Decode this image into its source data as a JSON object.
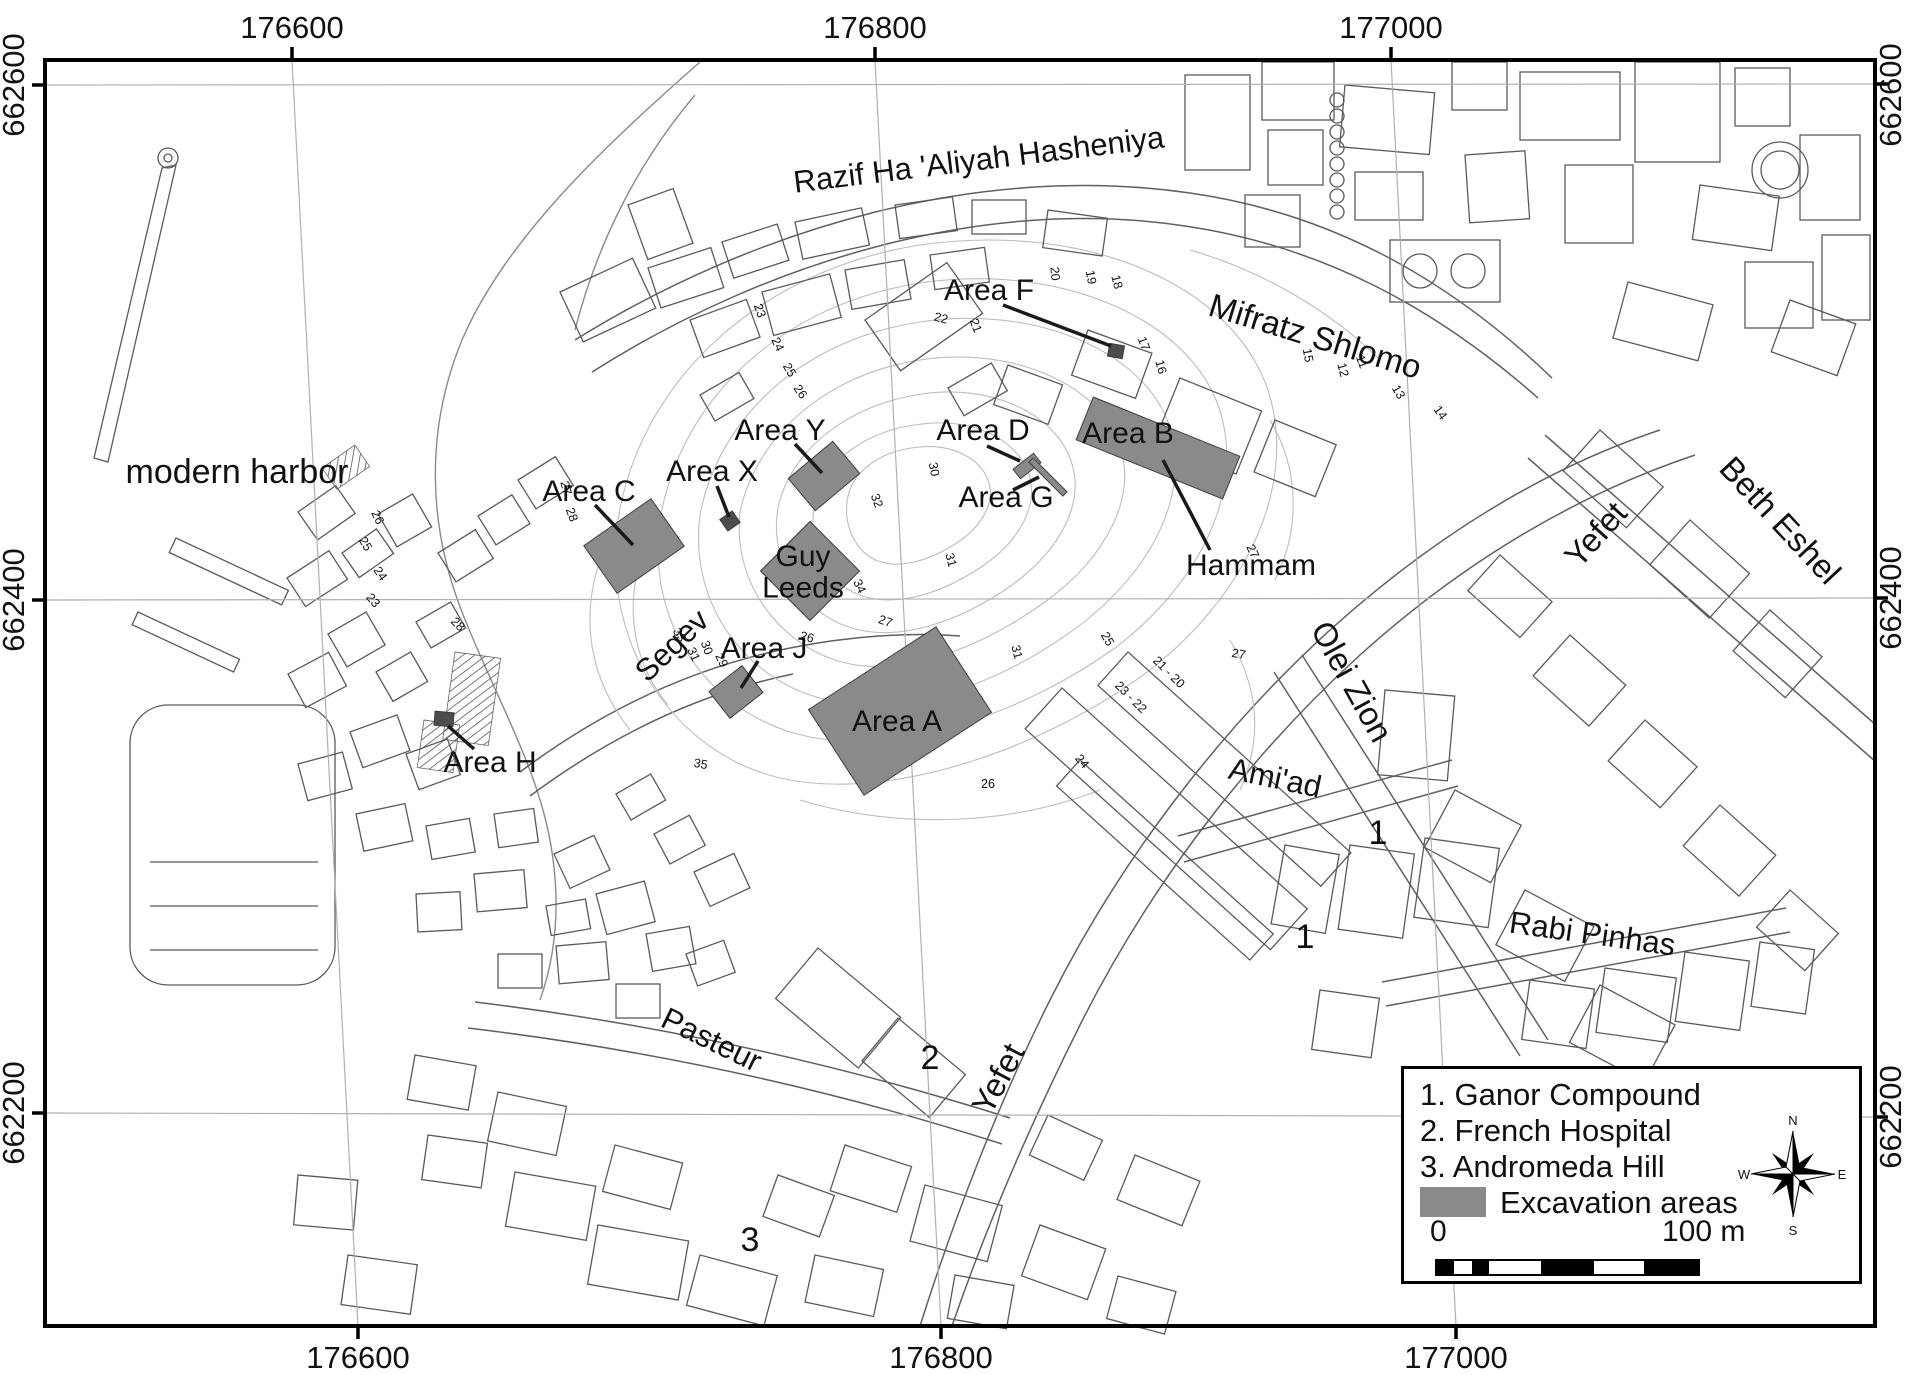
{
  "colors": {
    "excavation_fill": "#8a8a8a",
    "excavation_dark": "#4c4c4c",
    "leader": "#1a1a1a",
    "grid": "#b0b0b0",
    "border": "#000000",
    "text": "#111111",
    "contour_text": "#555555"
  },
  "frame": {
    "x": 45,
    "y": 60,
    "w": 1830,
    "h": 1266
  },
  "axes": {
    "top": [
      {
        "text": "176600",
        "x": 292
      },
      {
        "text": "176800",
        "x": 875
      },
      {
        "text": "177000",
        "x": 1391
      }
    ],
    "bottom": [
      {
        "text": "176600",
        "x": 358
      },
      {
        "text": "176800",
        "x": 941
      },
      {
        "text": "177000",
        "x": 1456
      }
    ],
    "left": [
      {
        "text": "662600",
        "y": 85
      },
      {
        "text": "662400",
        "y": 600
      },
      {
        "text": "662200",
        "y": 1113
      }
    ],
    "right": [
      {
        "text": "662600",
        "y": 95
      },
      {
        "text": "662400",
        "y": 598
      },
      {
        "text": "662200",
        "y": 1117
      }
    ]
  },
  "grid": {
    "vertical": [
      {
        "x_top": 292,
        "x_bottom": 358
      },
      {
        "x_top": 875,
        "x_bottom": 941
      },
      {
        "x_top": 1391,
        "x_bottom": 1456
      }
    ],
    "horizontal": [
      {
        "y_left": 85,
        "y_right": 84
      },
      {
        "y_left": 600,
        "y_right": 598
      },
      {
        "y_left": 1113,
        "y_right": 1117
      }
    ]
  },
  "map_labels": [
    {
      "name": "street-razif",
      "text": "Razif Ha 'Aliyah Hasheniya",
      "x": 980,
      "y": 170,
      "rot": -7,
      "size": 31
    },
    {
      "name": "street-mifratz-shlomo",
      "text": "Mifratz Shlomo",
      "x": 1312,
      "y": 347,
      "rot": 17,
      "size": 33
    },
    {
      "name": "street-yefet-north",
      "text": "Yefet",
      "x": 1604,
      "y": 542,
      "rot": -48,
      "size": 33
    },
    {
      "name": "street-beth-eshel",
      "text": "Beth Eshel",
      "x": 1772,
      "y": 528,
      "rot": 47,
      "size": 33
    },
    {
      "name": "street-olei-zion",
      "text": "Olei Zion",
      "x": 1342,
      "y": 687,
      "rot": 61,
      "size": 33
    },
    {
      "name": "street-amiad",
      "text": "Ami'ad",
      "x": 1273,
      "y": 788,
      "rot": 12,
      "size": 31
    },
    {
      "name": "street-rabi-pinhas",
      "text": "Rabi Pinhas",
      "x": 1591,
      "y": 944,
      "rot": 8,
      "size": 31
    },
    {
      "name": "street-pasteur",
      "text": "Pasteur",
      "x": 707,
      "y": 1049,
      "rot": 26,
      "size": 31
    },
    {
      "name": "street-segev",
      "text": "Segev",
      "x": 679,
      "y": 653,
      "rot": -44,
      "size": 31
    },
    {
      "name": "street-yefet-south",
      "text": "Yefet",
      "x": 1008,
      "y": 1084,
      "rot": -62,
      "size": 33
    },
    {
      "name": "place-modern-harbor",
      "text": "modern harbor",
      "x": 237,
      "y": 483,
      "rot": 0,
      "size": 34
    },
    {
      "name": "place-hammam",
      "text": "Hammam",
      "x": 1251,
      "y": 575,
      "rot": 0,
      "size": 30
    },
    {
      "name": "area-label-c",
      "text": "Area C",
      "x": 589,
      "y": 501,
      "rot": 0,
      "size": 30
    },
    {
      "name": "area-label-x",
      "text": "Area X",
      "x": 712,
      "y": 481,
      "rot": 0,
      "size": 30
    },
    {
      "name": "area-label-y",
      "text": "Area Y",
      "x": 780,
      "y": 440,
      "rot": 0,
      "size": 30
    },
    {
      "name": "area-label-d",
      "text": "Area D",
      "x": 983,
      "y": 440,
      "rot": 0,
      "size": 30
    },
    {
      "name": "area-label-g",
      "text": "Area G",
      "x": 1006,
      "y": 507,
      "rot": 0,
      "size": 30
    },
    {
      "name": "area-label-f",
      "text": "Area F",
      "x": 989,
      "y": 300,
      "rot": 0,
      "size": 30
    },
    {
      "name": "area-label-b",
      "text": "Area B",
      "x": 1128,
      "y": 443,
      "rot": 0,
      "size": 30
    },
    {
      "name": "area-label-j",
      "text": "Area J",
      "x": 764,
      "y": 658,
      "rot": 0,
      "size": 30
    },
    {
      "name": "area-label-a",
      "text": "Area A",
      "x": 897,
      "y": 731,
      "rot": 0,
      "size": 30
    },
    {
      "name": "area-label-h",
      "text": "Area H",
      "x": 490,
      "y": 772,
      "rot": 0,
      "size": 30
    },
    {
      "name": "area-label-guy-leeds",
      "lines": [
        "Guy",
        "Leeds"
      ],
      "x": 803,
      "y": 566,
      "rot": 0,
      "size": 30
    }
  ],
  "site_numbers": [
    {
      "text": "1",
      "x": 1378,
      "y": 844
    },
    {
      "text": "1",
      "x": 1305,
      "y": 948
    },
    {
      "text": "2",
      "x": 930,
      "y": 1069
    },
    {
      "text": "3",
      "x": 750,
      "y": 1251
    }
  ],
  "contour_labels": [
    {
      "text": "23",
      "x": 756,
      "y": 312,
      "rot": 70
    },
    {
      "text": "24",
      "x": 774,
      "y": 346,
      "rot": 65
    },
    {
      "text": "25",
      "x": 786,
      "y": 372,
      "rot": 60
    },
    {
      "text": "26",
      "x": 797,
      "y": 394,
      "rot": 55
    },
    {
      "text": "22",
      "x": 940,
      "y": 322,
      "rot": 15
    },
    {
      "text": "21",
      "x": 972,
      "y": 327,
      "rot": 70
    },
    {
      "text": "20",
      "x": 1051,
      "y": 274,
      "rot": 85
    },
    {
      "text": "19",
      "x": 1087,
      "y": 278,
      "rot": 80
    },
    {
      "text": "18",
      "x": 1113,
      "y": 283,
      "rot": 75
    },
    {
      "text": "15",
      "x": 1304,
      "y": 356,
      "rot": 80
    },
    {
      "text": "12",
      "x": 1339,
      "y": 371,
      "rot": 75
    },
    {
      "text": "11",
      "x": 1358,
      "y": 363,
      "rot": 70
    },
    {
      "text": "13",
      "x": 1395,
      "y": 394,
      "rot": 60
    },
    {
      "text": "14",
      "x": 1437,
      "y": 415,
      "rot": 55
    },
    {
      "text": "27",
      "x": 562,
      "y": 489,
      "rot": 75
    },
    {
      "text": "28",
      "x": 568,
      "y": 516,
      "rot": 70
    },
    {
      "text": "26",
      "x": 374,
      "y": 519,
      "rot": 65
    },
    {
      "text": "25",
      "x": 362,
      "y": 546,
      "rot": 60
    },
    {
      "text": "24",
      "x": 377,
      "y": 576,
      "rot": 55
    },
    {
      "text": "23",
      "x": 370,
      "y": 603,
      "rot": 50
    },
    {
      "text": "28",
      "x": 455,
      "y": 627,
      "rot": 45
    },
    {
      "text": "27",
      "x": 1249,
      "y": 553,
      "rot": 65
    },
    {
      "text": "27",
      "x": 1238,
      "y": 658,
      "rot": 10
    },
    {
      "text": "25",
      "x": 1104,
      "y": 641,
      "rot": 60
    },
    {
      "text": "23 - 22",
      "x": 1128,
      "y": 700,
      "rot": 45
    },
    {
      "text": "21 - 20",
      "x": 1166,
      "y": 675,
      "rot": 45
    },
    {
      "text": "24",
      "x": 1079,
      "y": 764,
      "rot": 50
    },
    {
      "text": "26",
      "x": 988,
      "y": 788,
      "rot": 0
    },
    {
      "text": "31",
      "x": 1013,
      "y": 653,
      "rot": 75
    },
    {
      "text": "30",
      "x": 930,
      "y": 470,
      "rot": 80
    },
    {
      "text": "32",
      "x": 873,
      "y": 502,
      "rot": 70
    },
    {
      "text": "31",
      "x": 947,
      "y": 561,
      "rot": 75
    },
    {
      "text": "34",
      "x": 856,
      "y": 588,
      "rot": 65
    },
    {
      "text": "35",
      "x": 700,
      "y": 768,
      "rot": 10
    },
    {
      "text": "33",
      "x": 676,
      "y": 637,
      "rot": 60
    },
    {
      "text": "31",
      "x": 690,
      "y": 656,
      "rot": 65
    },
    {
      "text": "30",
      "x": 703,
      "y": 649,
      "rot": 70
    },
    {
      "text": "29",
      "x": 718,
      "y": 662,
      "rot": 65
    },
    {
      "text": "26",
      "x": 806,
      "y": 641,
      "rot": 15
    },
    {
      "text": "27",
      "x": 884,
      "y": 625,
      "rot": 20
    },
    {
      "text": "16",
      "x": 1157,
      "y": 368,
      "rot": 75
    },
    {
      "text": "17",
      "x": 1140,
      "y": 345,
      "rot": 70
    }
  ],
  "excavation_areas": [
    {
      "name": "area-c",
      "cx": 634,
      "cy": 546,
      "w": 82,
      "h": 58,
      "rot": -35,
      "shade": "medium"
    },
    {
      "name": "area-x",
      "cx": 730,
      "cy": 521,
      "w": 15,
      "h": 14,
      "rot": -35,
      "shade": "dark"
    },
    {
      "name": "area-y",
      "cx": 824,
      "cy": 476,
      "w": 58,
      "h": 42,
      "rot": -40,
      "shade": "medium"
    },
    {
      "name": "guy-leeds",
      "cx": 810,
      "cy": 571,
      "w": 70,
      "h": 70,
      "rot": -45,
      "shade": "medium"
    },
    {
      "name": "area-j",
      "cx": 736,
      "cy": 692,
      "w": 42,
      "h": 34,
      "rot": -38,
      "shade": "medium"
    },
    {
      "name": "area-a",
      "cx": 900,
      "cy": 711,
      "w": 152,
      "h": 102,
      "rot": -33,
      "shade": "medium"
    },
    {
      "name": "area-b",
      "cx": 1158,
      "cy": 448,
      "w": 158,
      "h": 46,
      "rot": 22,
      "shade": "medium"
    },
    {
      "name": "area-d",
      "cx": 1027,
      "cy": 466,
      "w": 26,
      "h": 12,
      "rot": -38,
      "shade": "medium"
    },
    {
      "name": "area-g",
      "cx": 1048,
      "cy": 477,
      "w": 48,
      "h": 6,
      "rot": 45,
      "shade": "medium"
    },
    {
      "name": "area-f",
      "cx": 1116,
      "cy": 351,
      "w": 15,
      "h": 13,
      "rot": 10,
      "shade": "dark"
    },
    {
      "name": "area-h",
      "cx": 444,
      "cy": 719,
      "w": 19,
      "h": 14,
      "rot": 5,
      "shade": "dark"
    }
  ],
  "leader_lines": [
    {
      "x1": 595,
      "y1": 505,
      "x2": 633,
      "y2": 545
    },
    {
      "x1": 717,
      "y1": 486,
      "x2": 729,
      "y2": 517
    },
    {
      "x1": 795,
      "y1": 444,
      "x2": 822,
      "y2": 473
    },
    {
      "x1": 758,
      "y1": 661,
      "x2": 741,
      "y2": 688
    },
    {
      "x1": 987,
      "y1": 446,
      "x2": 1020,
      "y2": 461
    },
    {
      "x1": 1013,
      "y1": 490,
      "x2": 1039,
      "y2": 477
    },
    {
      "x1": 1003,
      "y1": 305,
      "x2": 1111,
      "y2": 346
    },
    {
      "x1": 1163,
      "y1": 460,
      "x2": 1210,
      "y2": 550
    },
    {
      "x1": 448,
      "y1": 726,
      "x2": 474,
      "y2": 749
    }
  ],
  "legend": {
    "items": [
      {
        "label": "1. Ganor Compound"
      },
      {
        "label": "2. French Hospital"
      },
      {
        "label": "3. Andromeda Hill"
      }
    ],
    "swatch_label": "Excavation areas",
    "scale": {
      "start_label": "0",
      "end_label": "100 m",
      "segments": [
        17,
        18,
        17,
        52,
        53,
        50,
        54
      ]
    },
    "compass": {
      "n": "N",
      "e": "E",
      "s": "S",
      "w": "W"
    }
  }
}
